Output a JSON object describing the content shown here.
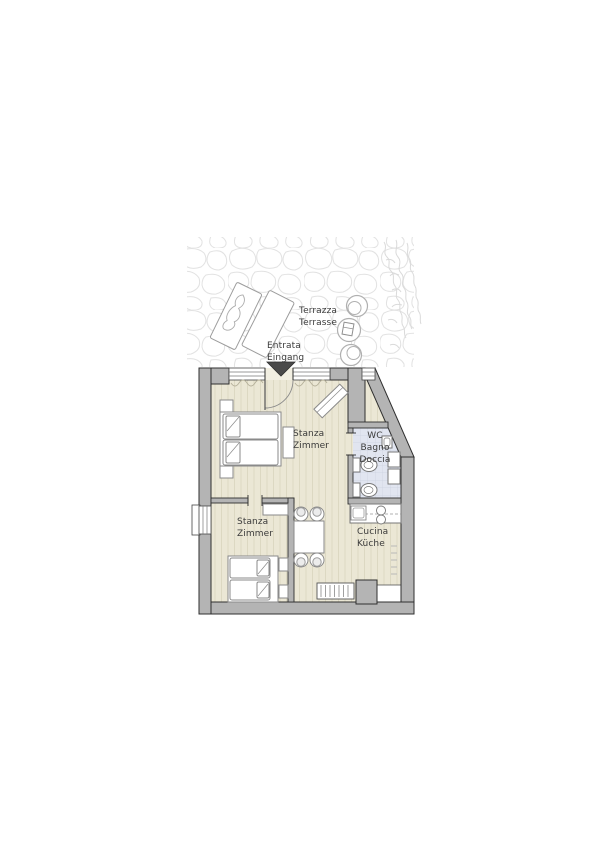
{
  "plan_title": "Apartment floor plan",
  "labels": {
    "terrace": [
      "Terrazza",
      "Terrasse"
    ],
    "entrance": [
      "Entrata",
      "Eingang"
    ],
    "bedroom1": [
      "Stanza",
      "Zimmer"
    ],
    "bathroom": [
      "WC",
      "Bagno",
      "Doccia"
    ],
    "bedroom2": [
      "Stanza",
      "Zimmer"
    ],
    "kitchen": [
      "Cucina",
      "Küche"
    ]
  },
  "colors": {
    "wall_fill": "#b4b4b4",
    "wall_stroke": "#2f2f2f",
    "wood_floor": "#ebe7d5",
    "wood_stripe": "#dcd8c2",
    "bath_floor": "#e1e5f0",
    "bath_grid": "#ccd2e0",
    "furniture_stroke": "#8a8a8a",
    "stone_outline": "#e2e2e2",
    "label_text": "#3b3b3b",
    "entrance_marker": "#4a4a4a"
  }
}
